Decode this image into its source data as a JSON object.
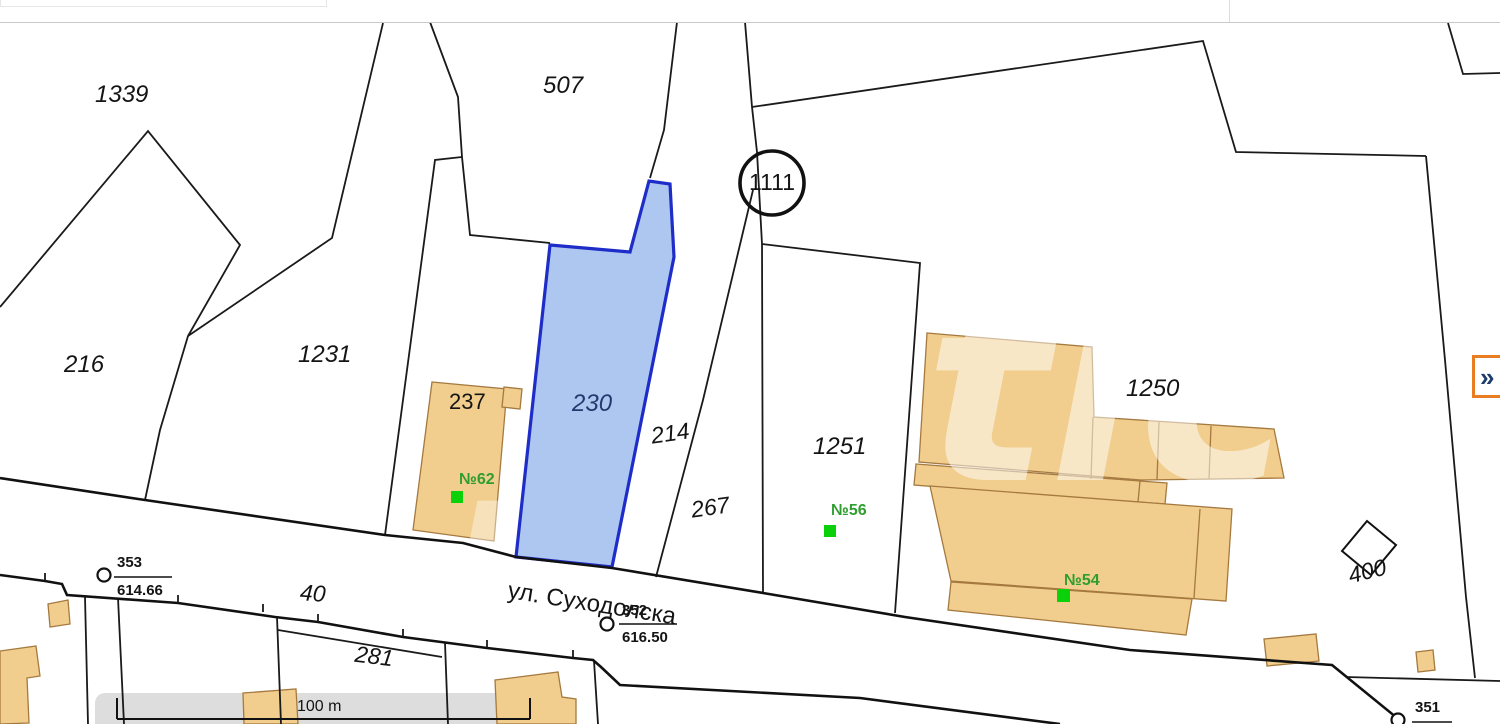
{
  "map": {
    "street": {
      "name": "ул. Суходолска"
    },
    "scale_bar": {
      "label": "100 m"
    },
    "block_circle": {
      "label": "1111"
    },
    "panel_button": {
      "glyph": "»"
    },
    "parcel_labels": {
      "p1339": "1339",
      "p216": "216",
      "p507": "507",
      "p1231": "1231",
      "p230": "230",
      "p214": "214",
      "p267": "267",
      "p1251": "1251",
      "p1250": "1250",
      "p400": "400",
      "p40": "40",
      "p281": "281",
      "p237": "237"
    },
    "building_labels": {
      "b62": "№62",
      "b56": "№56",
      "b54": "№54"
    },
    "survey_points": {
      "pt353": {
        "id": "353",
        "elevation": "614.66"
      },
      "pt352": {
        "id": "352",
        "elevation": "616.50"
      },
      "pt351": {
        "id": "351"
      }
    },
    "watermark": {
      "f1": "g",
      "f2": "rc",
      "f3": "tic"
    },
    "colors": {
      "selected_parcel_fill": "#a6c2ef",
      "selected_parcel_border": "#1e2cc8",
      "building_fill": "#f1ce8e",
      "building_border": "#a5793f",
      "number_green": "#2f9e2f",
      "marker_green": "#0ad10a",
      "label_navy": "#233a6e",
      "chip_orange": "#ea7c22",
      "chip_glyph": "#1d3d6b",
      "scale_band": "#d9d9d9"
    }
  }
}
